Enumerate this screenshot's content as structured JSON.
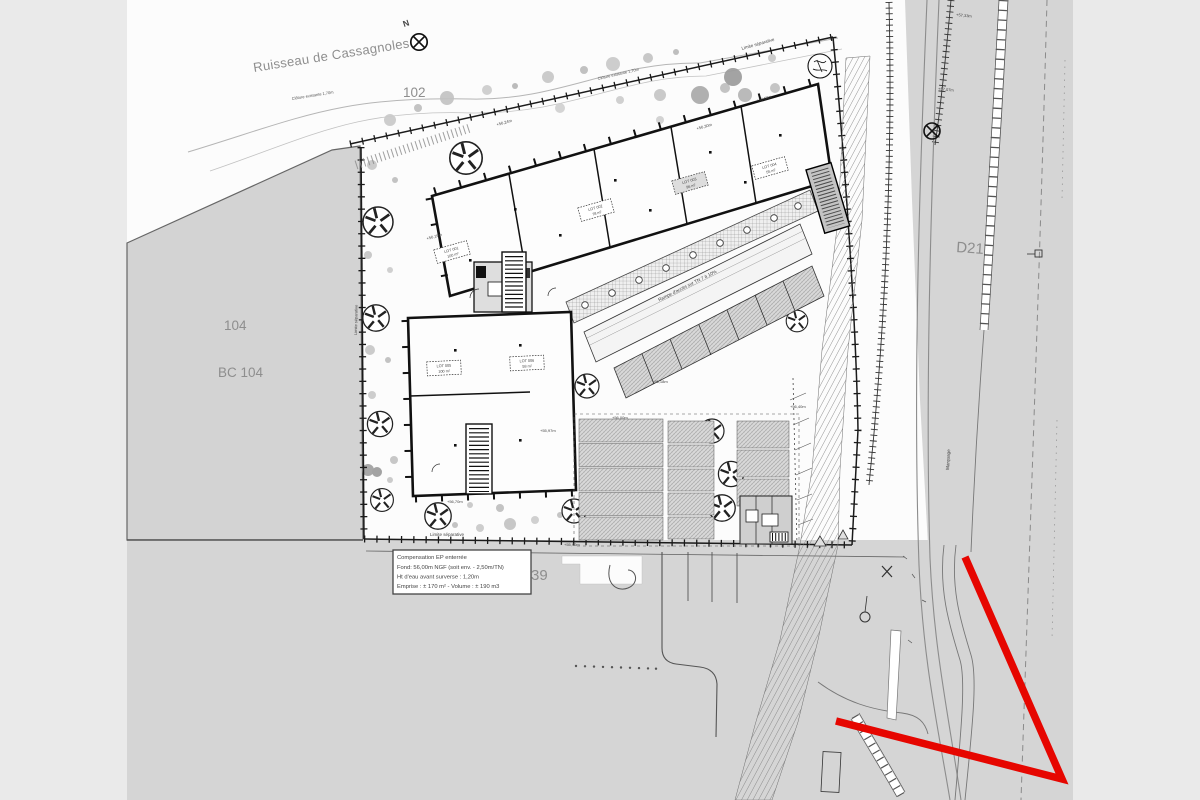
{
  "scene": {
    "stream_label": "Ruisseau de Cassagnoles",
    "north_label": "N",
    "parcel_102": "102",
    "parcel_104": "104",
    "parcel_bc104": "BC 104",
    "parcel_39": "39",
    "road_label": "D21",
    "marking_label": "Marquage",
    "fence_label": "Clôture existante 1,70m",
    "boundary_top_label": "Limite séparative",
    "boundary_left_label": "Limite séparative",
    "boundary_bottom_label": "Limite séparative",
    "ramp_label": "Rampe d'accès sur TN 7 à 10%",
    "red_color": "#e60600",
    "info_box": {
      "line1": "Compensation EP enterrée",
      "line2": "Fond: 56,00m NGF (soit env. - 2,50m/TN)",
      "line3": "Ht d'eau avant surverse : 1,20m",
      "line4": "Emprise : ± 170 m² - Volume : ± 190 m3"
    },
    "lots": [
      {
        "name": "LOT 001",
        "area": "100 m²"
      },
      {
        "name": "LOT 002",
        "area": "78 m²"
      },
      {
        "name": "LOT 003",
        "area": "96 m²"
      },
      {
        "name": "LOT 004",
        "area": "55 m²"
      },
      {
        "name": "LOT 005",
        "area": "100 m²"
      },
      {
        "name": "LOT 006",
        "area": "58 m²"
      }
    ],
    "elevations": [
      "+56,24m",
      "+56,00m",
      "+55,97m",
      "+56,18m",
      "+56,70m",
      "+56,16m",
      "+57,07m",
      "+56,30m",
      "+56,50m",
      "+55,90m",
      "+56,40m",
      "+57,33m"
    ]
  }
}
